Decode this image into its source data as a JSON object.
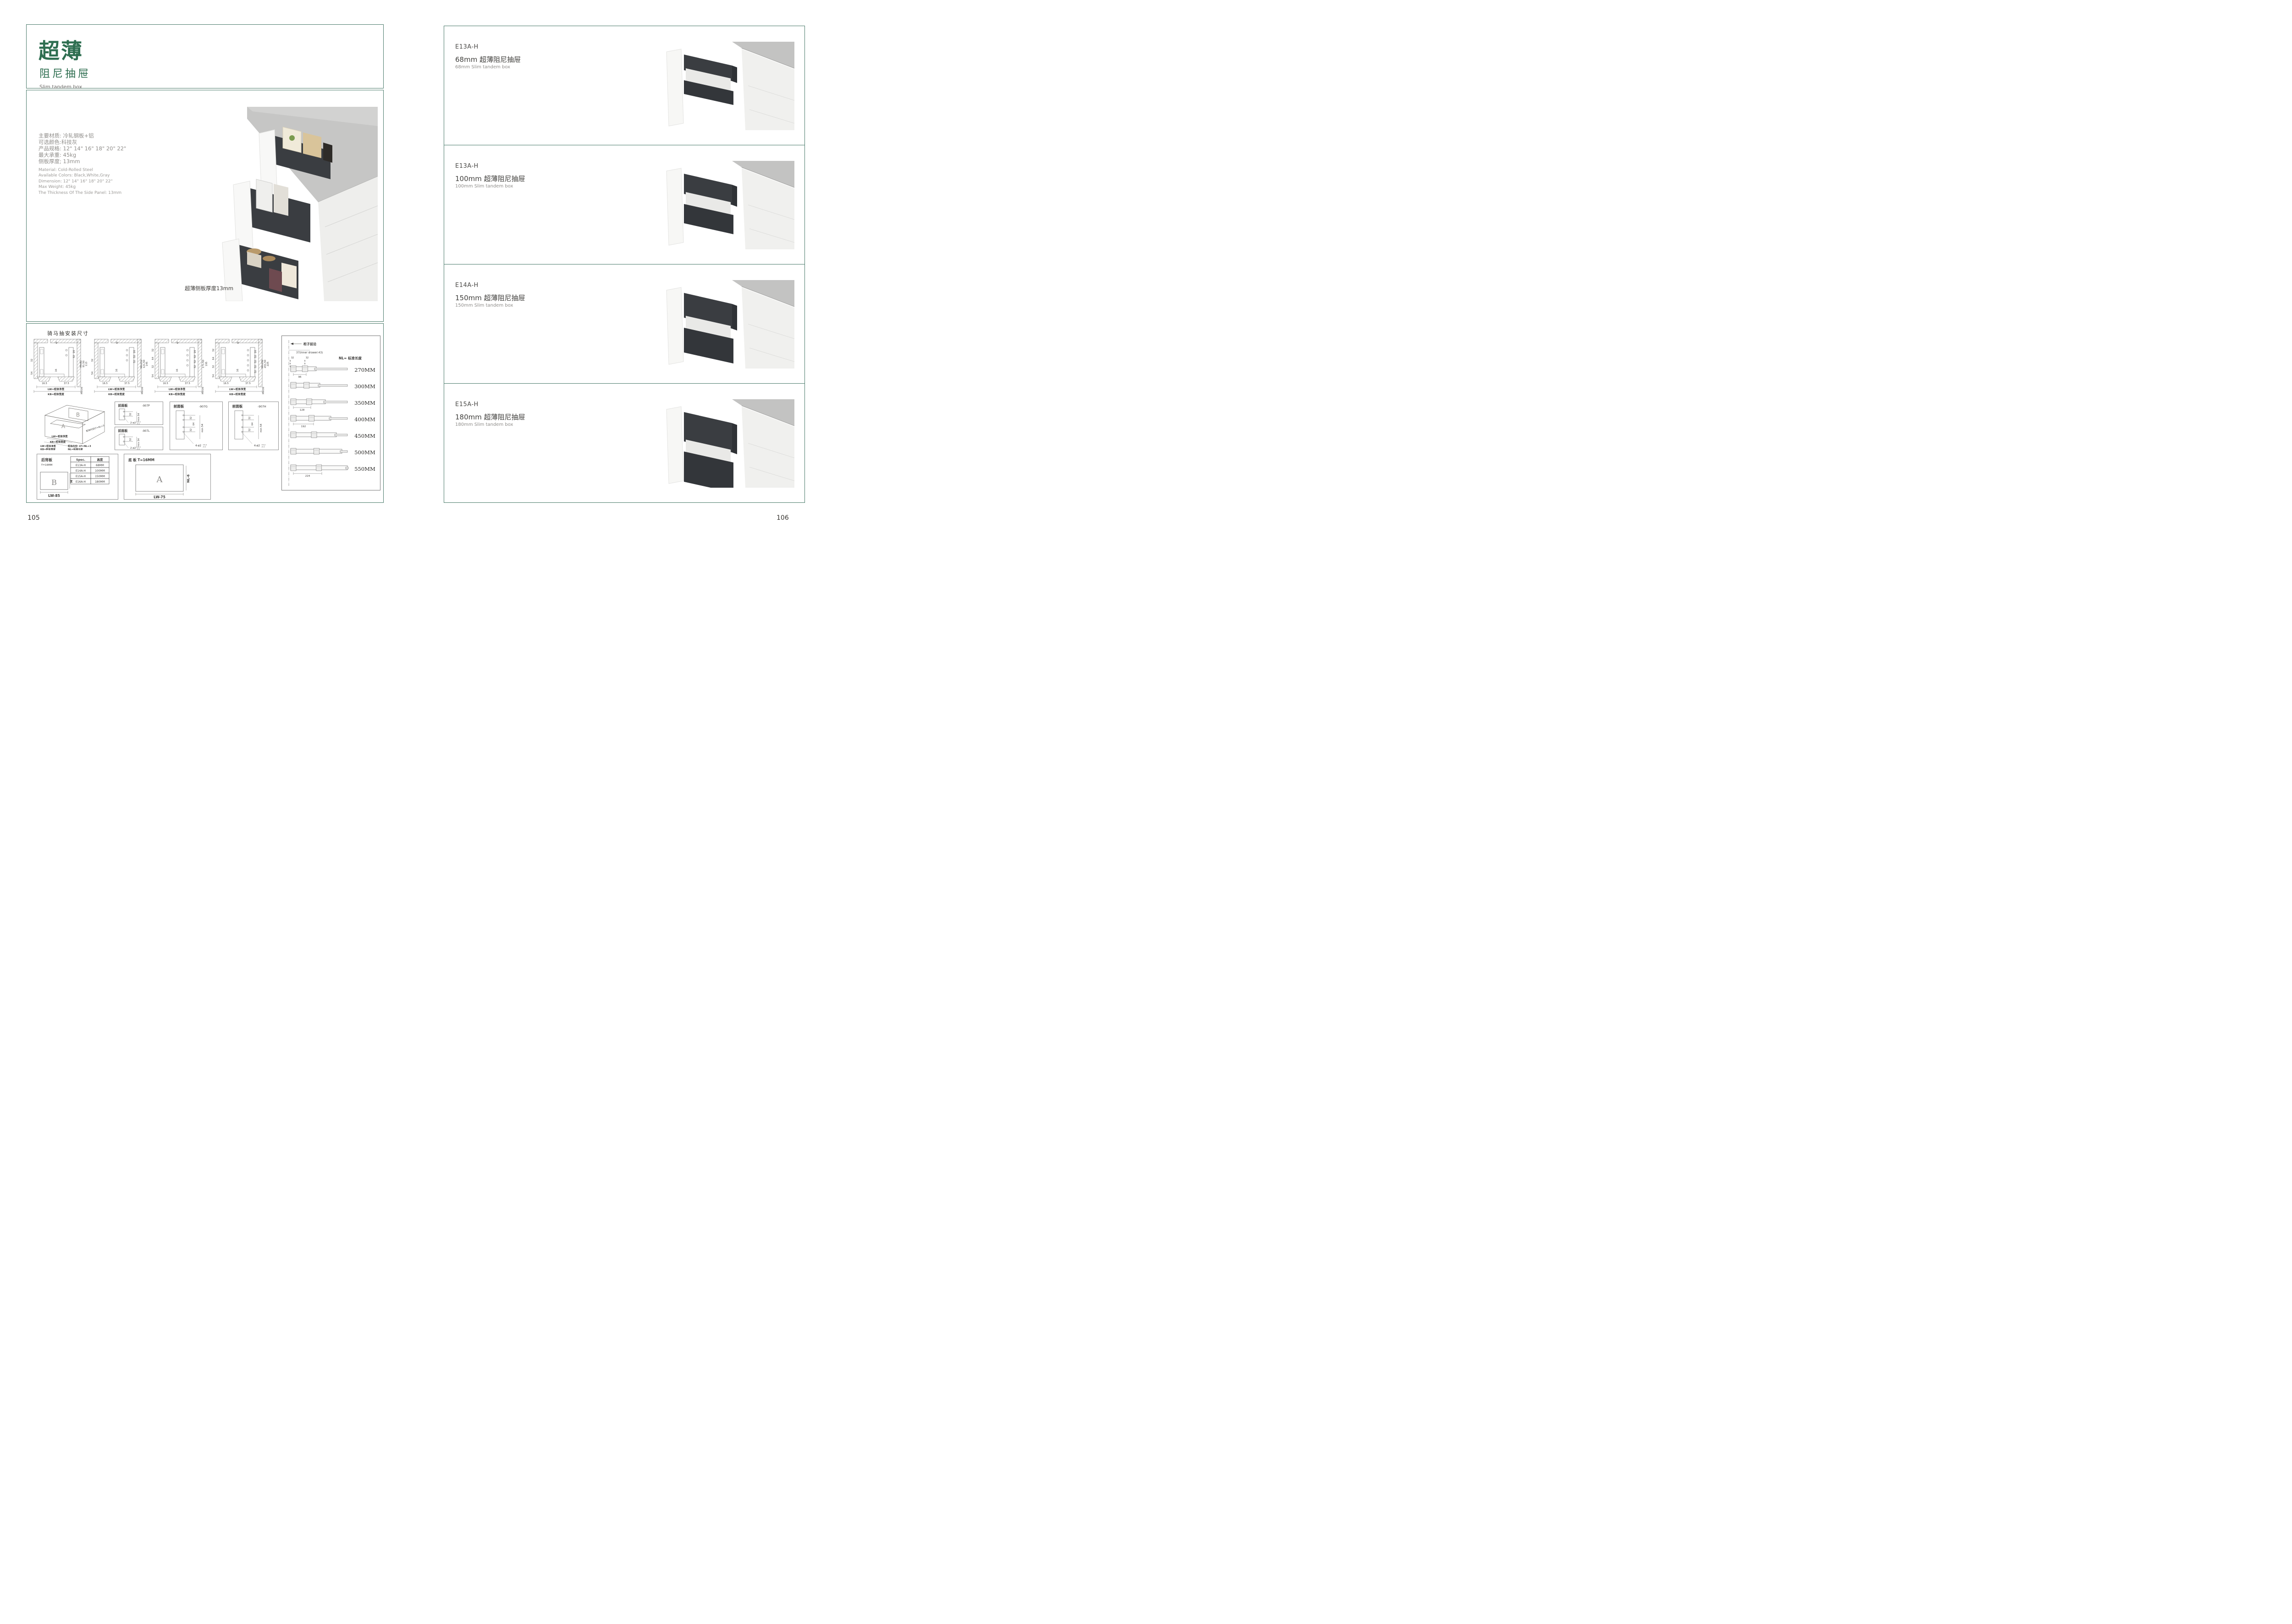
{
  "colors": {
    "accent_green": "#2e6e50",
    "box_border_teal": "#4a7a6a",
    "drawer_dark": "#393c40",
    "counter_gray": "#c2c2c1"
  },
  "page_left": {
    "page_number": "105",
    "title_cn_large": "超薄",
    "title_cn_sub": "阻尼抽屉",
    "title_en": "Slim tandem box",
    "specs_cn": [
      "主要材质: 冷轧钢板+铝",
      "可选颜色:科技灰",
      "产品规格: 12\" 14\" 16\" 18\" 20\" 22\"",
      "最大承重: 45kg",
      "侧板厚度; 13mm"
    ],
    "specs_en": [
      "Material: Cold-Rolled Steel",
      "Available Colors: Black,White,Gray",
      "Dimension: 12\" 14\" 16\" 18\" 20\" 22\"",
      "Max Weight: 45kg",
      "The Thickness Of The Side Panel: 13mm"
    ],
    "photo_caption": "超薄侧板厚度13mm",
    "drawings": {
      "heading": "骑马抽安装尺寸",
      "install_diagrams": [
        {
          "top": "9",
          "col": [
            "20",
            "32"
          ],
          "left": [
            "32",
            "54"
          ],
          "mid": "16",
          "right": [
            "Min82",
            "91.50",
            "113"
          ],
          "bottom_left": "16.5",
          "bottom_right": "37.5",
          "bottom_min": "Min36",
          "lw": "LW=柜体净宽",
          "kb": "KB=柜体宽度",
          "holes": 2
        },
        {
          "top": "9",
          "col": [
            "20",
            "32",
            "32"
          ],
          "left": [
            "32",
            "54"
          ],
          "mid": "16",
          "right": [
            "Min112",
            "121.50",
            "145"
          ],
          "bottom_left": "16.5",
          "bottom_right": "37.5",
          "bottom_min": "Min36",
          "lw": "LW=柜体净宽",
          "kb": "KB=柜体宽度",
          "holes": 3
        },
        {
          "top": "9",
          "col": [
            "20",
            "32",
            "32",
            "32"
          ],
          "left": [
            "32",
            "64",
            "32",
            "54"
          ],
          "mid": "16",
          "right": [
            "171.50",
            "195"
          ],
          "bottom_left": "16.5",
          "bottom_right": "37.5",
          "bottom_min": "Min36",
          "lw": "LW=柜体净宽",
          "kb": "KB=柜体宽度",
          "holes": 4
        },
        {
          "top": "9",
          "col": [
            "20",
            "32",
            "32",
            "32",
            "32"
          ],
          "left": [
            "32",
            "64",
            "32",
            "54"
          ],
          "mid": "16",
          "right": [
            "Min192",
            "201.50",
            "225"
          ],
          "bottom_left": "16.5",
          "bottom_right": "37.5",
          "bottom_min": "Min36",
          "lw": "LW=柜体净宽",
          "kb": "KB=柜体宽度",
          "holes": 5
        }
      ],
      "iso": {
        "plate_a": "A",
        "plate_b": "B",
        "label_lw": "LW=柜体净宽",
        "label_kb": "KB=柜体宽度",
        "label_slope": "柜体内空LT=NL+3",
        "legend": [
          "LW=柜体净宽",
          "KB=柜体宽度",
          "柜体内空: LT=NL+3",
          "NL=标准长度"
        ]
      },
      "front_panels": [
        {
          "title": "前面板",
          "code": "-907P",
          "dims": [
            "32"
          ],
          "min": "min 54",
          "note": "2-ø2",
          "tol_up": "+0.2",
          "tol_dn": "-0.1",
          "holes": 2
        },
        {
          "title": "前面板",
          "code": "-907L",
          "dims": [
            "32"
          ],
          "min": "min 54",
          "note": "2-ø2",
          "tol_up": "+0.2",
          "tol_dn": "-0.1",
          "holes": 2
        },
        {
          "title": "前面板",
          "code": "-907G",
          "dims": [
            "32",
            "64",
            "32"
          ],
          "min": "min 54",
          "note": "4-ø2",
          "tol_up": "+0.2",
          "tol_dn": "-0.1",
          "holes": 4
        },
        {
          "title": "前面板",
          "code": "-907H",
          "dims": [
            "32",
            "64",
            "32"
          ],
          "min": "min 54",
          "note": "4-ø2",
          "tol_up": "+0.2",
          "tol_dn": "-0.1",
          "holes": 4
        }
      ],
      "back_panel": {
        "title": "后背板",
        "thickness": "T=16MM",
        "table": {
          "headers": [
            "Spec.",
            "高度"
          ],
          "rows": [
            [
              "E13A-H",
              "68MM"
            ],
            [
              "E14A-H",
              "100MM"
            ],
            [
              "E15A-H",
              "150MM"
            ],
            [
              "E16A-H",
              "180MM"
            ]
          ]
        },
        "plate": "B",
        "height_label": "H",
        "width_label": "LW-85"
      },
      "bottom_panel": {
        "title": "底 板 T=16MM",
        "plate": "A",
        "nl_label": "NL-6",
        "width_label": "LW-75"
      },
      "length_chart": {
        "front_edge": "柜子前沿",
        "offset_note": "37(Inner drawer:43)",
        "pitch": "32",
        "hole_pitch": "9",
        "nl_label": "NL= 标准长度",
        "slides": [
          {
            "label": "270MM",
            "dim": "96"
          },
          {
            "label": "300MM",
            "dim": ""
          },
          {
            "label": "350MM",
            "dim": "128"
          },
          {
            "label": "400MM",
            "dim": "192"
          },
          {
            "label": "450MM",
            "dim": ""
          },
          {
            "label": "500MM",
            "dim": ""
          },
          {
            "label": "550MM",
            "dim": "224"
          }
        ]
      }
    }
  },
  "page_right": {
    "page_number": "106",
    "products": [
      {
        "code": "E13A-H",
        "title_cn": "68mm 超薄阻尼抽屉",
        "title_en": "68mm Slim tandem box"
      },
      {
        "code": "E13A-H",
        "title_cn": "100mm 超薄阻尼抽屉",
        "title_en": "100mm Slim tandem box"
      },
      {
        "code": "E14A-H",
        "title_cn": "150mm 超薄阻尼抽屉",
        "title_en": "150mm Slim tandem box"
      },
      {
        "code": "E15A-H",
        "title_cn": "180mm 超薄阻尼抽屉",
        "title_en": "180mm Slim tandem box"
      }
    ]
  }
}
